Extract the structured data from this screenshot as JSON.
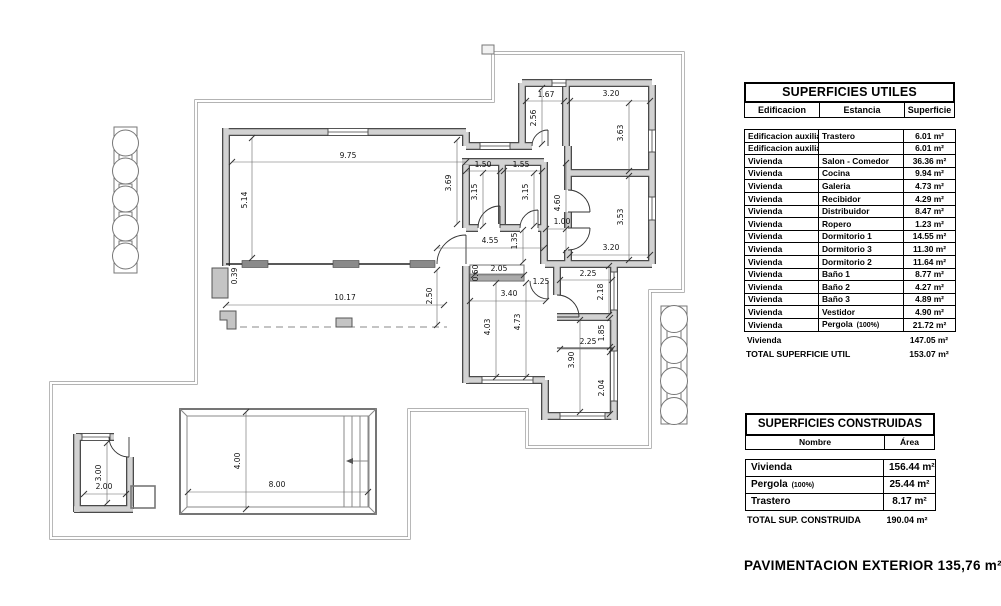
{
  "tables": {
    "utiles": {
      "title": "SUPERFICIES UTILES",
      "columns": [
        "Edificacion",
        "Estancia",
        "Superficie"
      ],
      "rows": [
        [
          "Edificacion auxiliar",
          "Trastero",
          "6.01 m²"
        ],
        [
          "Edificacion auxiliar",
          "",
          "6.01 m²"
        ],
        [
          "Vivienda",
          "Salon - Comedor",
          "36.36 m²"
        ],
        [
          "Vivienda",
          "Cocina",
          "9.94 m²"
        ],
        [
          "Vivienda",
          "Galeria",
          "4.73 m²"
        ],
        [
          "Vivienda",
          "Recibidor",
          "4.29 m²"
        ],
        [
          "Vivienda",
          "Distribuidor",
          "8.47 m²"
        ],
        [
          "Vivienda",
          "Ropero",
          "1.23 m²"
        ],
        [
          "Vivienda",
          "Dormitorio 1",
          "14.55 m²"
        ],
        [
          "Vivienda",
          "Dormitorio 3",
          "11.30 m²"
        ],
        [
          "Vivienda",
          "Dormitorio 2",
          "11.64 m²"
        ],
        [
          "Vivienda",
          "Baño 1",
          "8.77 m²"
        ],
        [
          "Vivienda",
          "Baño 2",
          "4.27 m²"
        ],
        [
          "Vivienda",
          "Baño 3",
          "4.89 m²"
        ],
        [
          "Vivienda",
          "Vestidor",
          "4.90 m²"
        ],
        [
          "Vivienda",
          {
            "text": "Pergola",
            "note": "(100%)"
          },
          "21.72 m²"
        ]
      ],
      "subtotal": {
        "label": "Vivienda",
        "value": "147.05 m²"
      },
      "total": {
        "label": "TOTAL SUPERFICIE UTIL",
        "value": "153.07 m²"
      }
    },
    "construidas": {
      "title": "SUPERFICIES CONSTRUIDAS",
      "columns": [
        "Nombre",
        "Área"
      ],
      "rows": [
        {
          "name": "Vivienda",
          "value": "156.44 m²"
        },
        {
          "name": "Pergola",
          "note": "(100%)",
          "value": "25.44 m²"
        },
        {
          "name": "Trastero",
          "value": "8.17 m²"
        }
      ],
      "total": {
        "label": "TOTAL SUP. CONSTRUIDA",
        "value": "190.04 m²"
      }
    }
  },
  "footer_note": "PAVIMENTACION EXTERIOR 135,76 m²",
  "floorplan": {
    "dimensions": [
      {
        "t": "9.75",
        "x": 348,
        "y": 158,
        "r": 0,
        "l": [
          232,
          162,
          466,
          162
        ]
      },
      {
        "t": "5.14",
        "x": 247,
        "y": 200,
        "r": -90,
        "l": [
          252,
          138,
          252,
          258
        ]
      },
      {
        "t": "0.39",
        "x": 237,
        "y": 276,
        "r": -90
      },
      {
        "t": "3.69",
        "x": 451,
        "y": 183,
        "r": -90,
        "l": [
          457,
          140,
          457,
          224
        ]
      },
      {
        "t": "1.50",
        "x": 483,
        "y": 167,
        "r": 0,
        "l": [
          466,
          171,
          500,
          171
        ]
      },
      {
        "t": "1.55",
        "x": 521,
        "y": 167,
        "r": 0,
        "l": [
          504,
          171,
          542,
          171
        ]
      },
      {
        "t": "3.15",
        "x": 477,
        "y": 192,
        "r": -90,
        "l": [
          483,
          173,
          483,
          226
        ]
      },
      {
        "t": "3.15",
        "x": 528,
        "y": 192,
        "r": -90,
        "l": [
          534,
          173,
          534,
          226
        ]
      },
      {
        "t": "1.67",
        "x": 546,
        "y": 97,
        "r": 0,
        "l": [
          526,
          101,
          564,
          101
        ]
      },
      {
        "t": "2.56",
        "x": 536,
        "y": 118,
        "r": -90,
        "l": [
          542,
          88,
          542,
          144
        ]
      },
      {
        "t": "3.20",
        "x": 611,
        "y": 96,
        "r": 0,
        "l": [
          570,
          101,
          650,
          101
        ]
      },
      {
        "t": "3.63",
        "x": 623,
        "y": 133,
        "r": -90,
        "l": [
          629,
          103,
          629,
          171
        ]
      },
      {
        "t": "3.53",
        "x": 623,
        "y": 217,
        "r": -90,
        "l": [
          629,
          176,
          629,
          260
        ]
      },
      {
        "t": "3.20",
        "x": 611,
        "y": 250,
        "r": 0,
        "l": [
          570,
          255,
          650,
          255
        ]
      },
      {
        "t": "4.60",
        "x": 560,
        "y": 203,
        "r": -90,
        "l": [
          566,
          163,
          566,
          250
        ]
      },
      {
        "t": "1.00",
        "x": 562,
        "y": 224,
        "r": 0,
        "l": [
          546,
          229,
          566,
          229
        ]
      },
      {
        "t": "4.55",
        "x": 490,
        "y": 243,
        "r": 0,
        "l": [
          437,
          248,
          544,
          248
        ]
      },
      {
        "t": "1.35",
        "x": 517,
        "y": 241,
        "r": -90,
        "l": [
          523,
          230,
          523,
          262
        ]
      },
      {
        "t": "2.05",
        "x": 499,
        "y": 271,
        "r": 0,
        "l": [
          474,
          275,
          524,
          275
        ]
      },
      {
        "t": "0.60",
        "x": 478,
        "y": 273,
        "r": -90
      },
      {
        "t": "1.25",
        "x": 541,
        "y": 284,
        "r": 0
      },
      {
        "t": "3.40",
        "x": 509,
        "y": 296,
        "r": 0,
        "l": [
          470,
          301,
          546,
          301
        ]
      },
      {
        "t": "4.03",
        "x": 490,
        "y": 327,
        "r": -90,
        "l": [
          496,
          283,
          496,
          377
        ]
      },
      {
        "t": "4.73",
        "x": 520,
        "y": 322,
        "r": -90,
        "l": [
          526,
          283,
          526,
          377
        ]
      },
      {
        "t": "2.25",
        "x": 588,
        "y": 276,
        "r": 0,
        "l": [
          560,
          280,
          612,
          280
        ]
      },
      {
        "t": "2.18",
        "x": 603,
        "y": 292,
        "r": -90,
        "l": [
          609,
          266,
          609,
          315
        ]
      },
      {
        "t": "2.25",
        "x": 588,
        "y": 344,
        "r": 0,
        "l": [
          560,
          349,
          612,
          349
        ]
      },
      {
        "t": "1.85",
        "x": 604,
        "y": 333,
        "r": -90,
        "l": [
          610,
          318,
          610,
          347
        ]
      },
      {
        "t": "3.90",
        "x": 574,
        "y": 360,
        "r": -90,
        "l": [
          580,
          320,
          580,
          412
        ]
      },
      {
        "t": "2.04",
        "x": 604,
        "y": 388,
        "r": -90,
        "l": [
          610,
          352,
          610,
          414
        ]
      },
      {
        "t": "2.50",
        "x": 432,
        "y": 296,
        "r": -90,
        "l": [
          437,
          270,
          437,
          325
        ]
      },
      {
        "t": "10.17",
        "x": 345,
        "y": 300,
        "r": 0,
        "l": [
          226,
          305,
          444,
          305
        ]
      },
      {
        "t": "3.00",
        "x": 101,
        "y": 473,
        "r": -90,
        "l": [
          107,
          443,
          107,
          503
        ]
      },
      {
        "t": "2.00",
        "x": 104,
        "y": 489,
        "r": 0,
        "l": [
          84,
          494,
          126,
          494
        ]
      },
      {
        "t": "8.00",
        "x": 277,
        "y": 487,
        "r": 0,
        "l": [
          188,
          492,
          368,
          492
        ]
      },
      {
        "t": "4.00",
        "x": 240,
        "y": 461,
        "r": -90,
        "l": [
          246,
          412,
          246,
          509
        ]
      }
    ]
  }
}
